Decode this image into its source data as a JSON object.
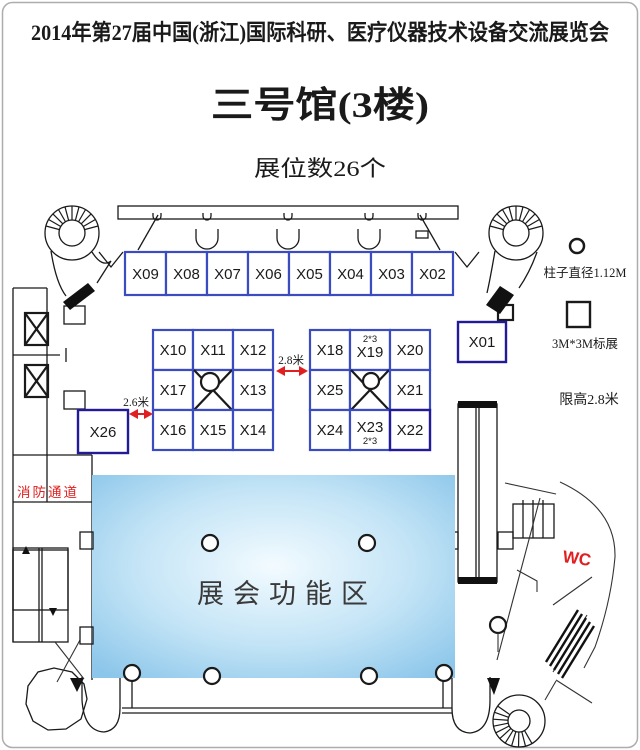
{
  "header": {
    "title": "2014年第27届中国(浙江)国际科研、医疗仪器技术设备交流展览会",
    "hall": "三号馆(3楼)",
    "booth_count": "展位数26个"
  },
  "legend": {
    "pillar": "柱子直径1.12M",
    "standard_booth": "3M*3M标展",
    "height_limit": "限高2.8米"
  },
  "labels": {
    "aisle_right": "2.8米",
    "aisle_left": "2.6米",
    "fire_lane": "消防通道",
    "wc": "WC",
    "function_area": "展会功能区",
    "spec_x19": "2*3",
    "spec_x23": "2*3"
  },
  "booths": {
    "top_row": [
      "X09",
      "X08",
      "X07",
      "X06",
      "X05",
      "X04",
      "X03",
      "X02"
    ],
    "left_block": [
      "X10",
      "X11",
      "X12",
      "X17",
      "X13",
      "X16",
      "X15",
      "X14"
    ],
    "right_block": [
      "X18",
      "X19",
      "X20",
      "X25",
      "X21",
      "X24",
      "X23",
      "X22"
    ],
    "single_right": "X01",
    "single_left": "X26"
  },
  "colors": {
    "booth_border": "#3a4cc0",
    "booth_border_dark": "#221a96",
    "accent_red": "#e02020",
    "function_area_fill": "#8cc6ea",
    "wall": "#1a1a1a",
    "page_border": "#adadad"
  }
}
